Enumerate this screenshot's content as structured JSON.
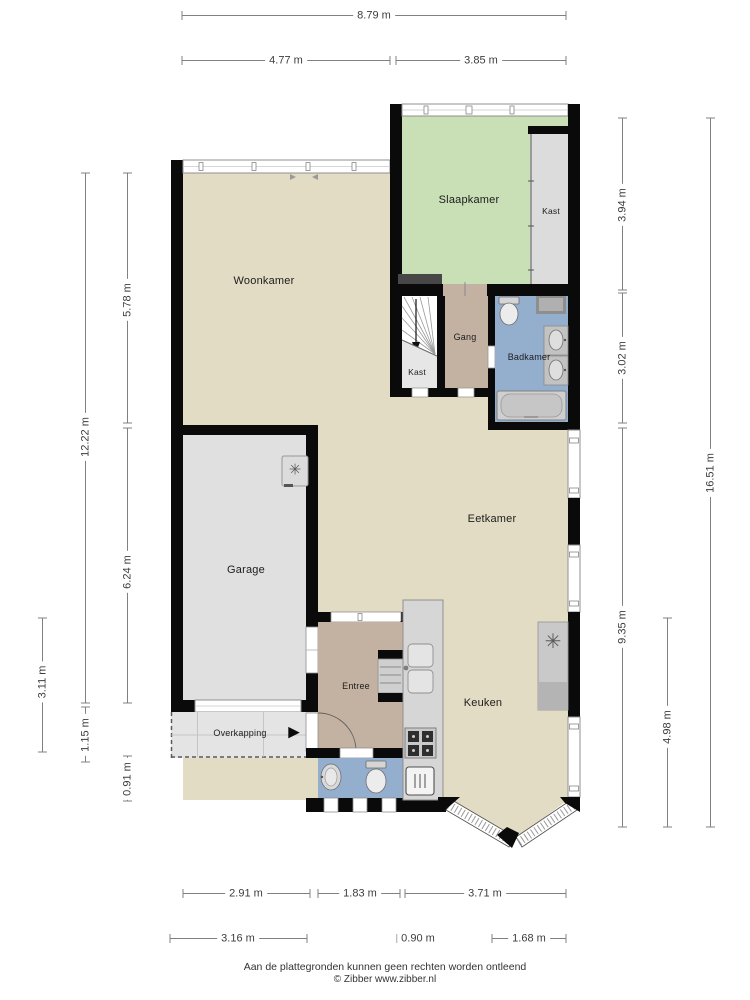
{
  "title": "Plattegrond begane grond",
  "rooms": {
    "woonkamer": "Woonkamer",
    "slaapkamer": "Slaapkamer",
    "kast_slaapkamer": "Kast",
    "gang": "Gang",
    "kast_trap": "Kast",
    "badkamer": "Badkamer",
    "eetkamer": "Eetkamer",
    "garage": "Garage",
    "entree": "Entree",
    "keuken": "Keuken",
    "overkapping": "Overkapping"
  },
  "dims": {
    "width_total": "8.79 m",
    "width_left": "4.77 m",
    "width_right": "3.85 m",
    "right_top": "3.94 m",
    "right_middle": "3.02 m",
    "right_bottom": "9.35 m",
    "right_inner_bottom": "4.98 m",
    "right_total": "16.51 m",
    "left_total": "12.22 m",
    "left_top": "5.78 m",
    "left_middle": "6.24 m",
    "left_outer_bottom": "3.11 m",
    "left_bottom_a": "1.15 m",
    "left_bottom_b": "0.91 m",
    "bottom_inner": [
      "2.91 m",
      "1.83 m",
      "3.71 m"
    ],
    "bottom_outer": [
      "3.16 m",
      "0.90 m",
      "1.68 m"
    ]
  },
  "icons": {
    "fan": "✳",
    "entrance_arrow": "▶"
  },
  "colors": {
    "floor_beige": "#e3dcc4",
    "bedroom_green": "#c9dfb5",
    "bathroom_blue": "#94aece",
    "hall_brown": "#c3b2a2",
    "garage_grey": "#e0e0e0",
    "wall_black": "#0a0a0a",
    "counter_grey": "#d6d6d6"
  },
  "footer": {
    "line1": "Aan de plattegronden kunnen geen rechten worden ontleend",
    "line2": "© Zibber www.zibber.nl"
  }
}
